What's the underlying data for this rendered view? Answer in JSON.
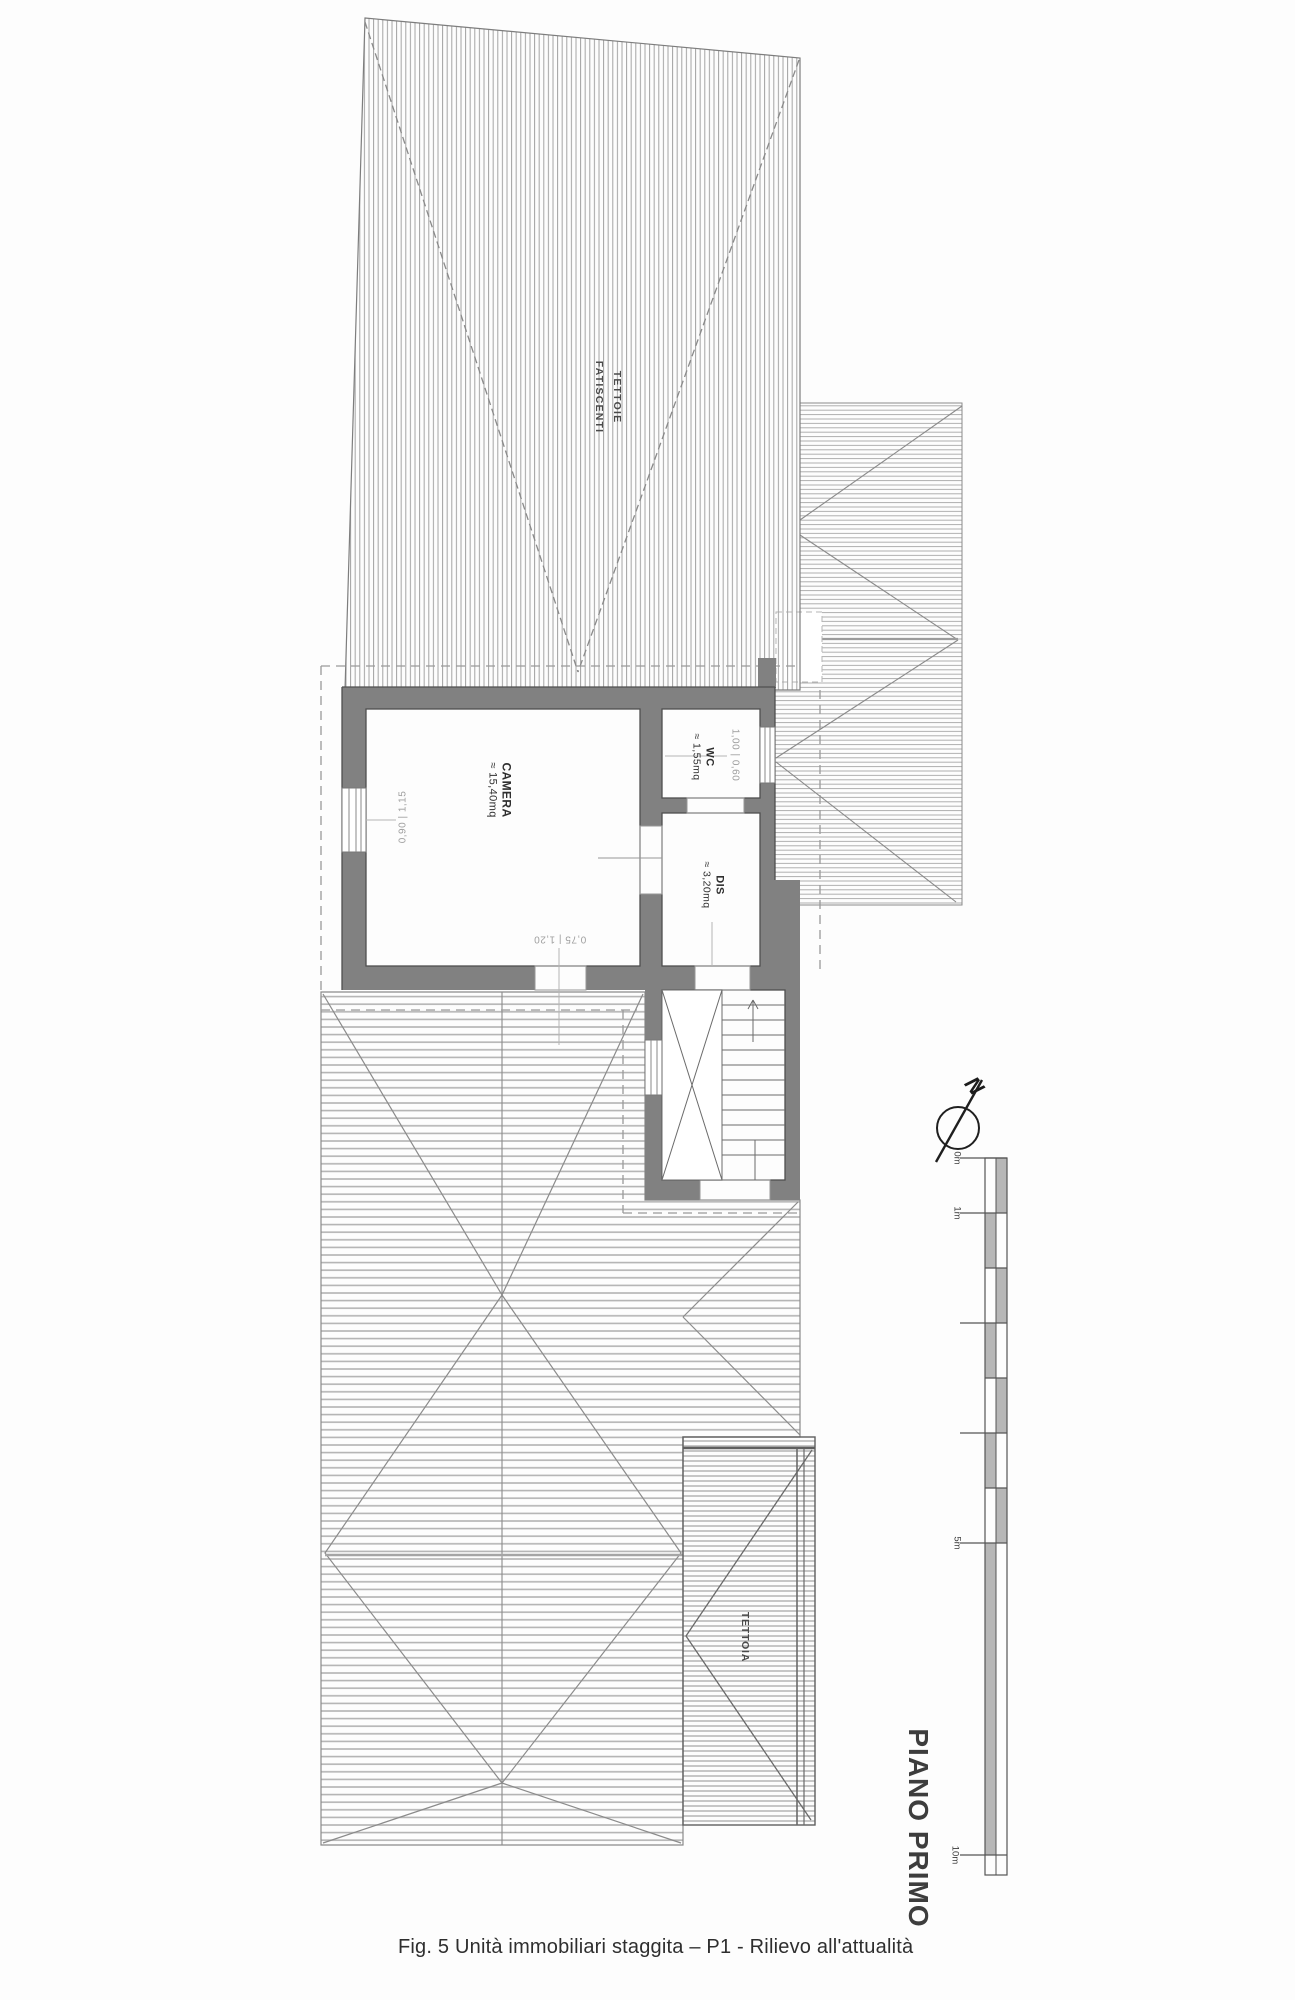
{
  "document": {
    "type": "floor-plan-scan",
    "caption": "Fig. 5 Unità immobiliari staggita – P1 - Rilievo all'attualità",
    "floor_title": "PIANO PRIMO"
  },
  "roofs": {
    "top_roof_line1": "TETTOIE",
    "top_roof_line2": "FATISCENTI",
    "small_roof": "TETTOIA"
  },
  "rooms": {
    "camera": {
      "name": "CAMERA",
      "area": "≈ 15,40mq"
    },
    "wc": {
      "name": "WC",
      "area": "≈ 1,55mq"
    },
    "dis": {
      "name": "DIS",
      "area": "≈ 3,20mq"
    }
  },
  "dimensions": {
    "window_left": "0,90 | 1,15",
    "window_wc": "1,00 | 0,60",
    "door_camera": "0,75 | 1,20"
  },
  "north": {
    "letter": "N"
  },
  "scale_bar": {
    "labels": [
      "0m",
      "1m",
      "5m",
      "10m"
    ]
  },
  "colors": {
    "wall_fill": "#818181",
    "wall_edge": "#4f4f4f",
    "hatch_vertical": "#a3a3a3",
    "hatch_horizontal": "#b3b3b3",
    "dash_line": "#9a9a9a",
    "dim_text": "#9e9e9e",
    "label_text": "#2f2f2f"
  }
}
